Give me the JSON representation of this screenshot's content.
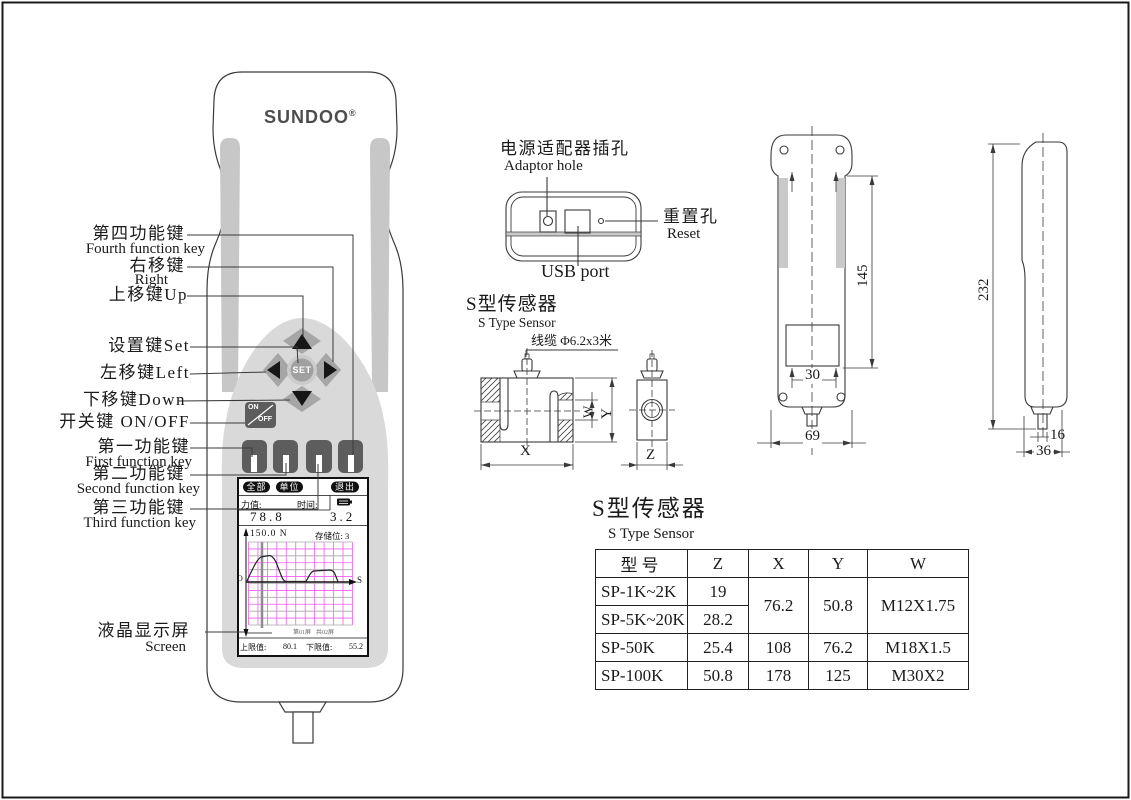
{
  "brand": {
    "logo_text": "SUNDOO",
    "logo_reg": "®"
  },
  "device_callouts": {
    "fourth_fn_cn": "第四功能键",
    "fourth_fn_en": "Fourth function key",
    "right_cn": "右移键",
    "right_en": "Right",
    "up": "上移键Up",
    "set": "设置键Set",
    "left": "左移键Left",
    "down": "下移键Down",
    "onoff": "开关键 ON/OFF",
    "first_fn_cn": "第一功能键",
    "first_fn_en": "First function key",
    "second_fn_cn": "第二功能键",
    "second_fn_en": "Second function key",
    "third_fn_cn": "第三功能键",
    "third_fn_en": "Third function key",
    "screen_cn": "液晶显示屏",
    "screen_en": "Screen"
  },
  "keypad": {
    "set": "SET",
    "on": "ON",
    "off": "OFF"
  },
  "screen": {
    "softkey_all": "全部",
    "softkey_unit": "单位",
    "softkey_exit": "退出",
    "force_label": "力值:",
    "time_label": "时间:",
    "force_value": "78.8",
    "time_value": "3.2",
    "fullscale_label": "150.0 N",
    "storage_label": "存储位: 3",
    "origin": "O",
    "axis_s": "S",
    "page_cur": "第01屏",
    "page_total": "共02屏",
    "upper_label": "上限值:",
    "upper_value": "80.1",
    "lower_label": "下限值:",
    "lower_value": "55.2"
  },
  "top_view": {
    "adaptor_cn": "电源适配器插孔",
    "adaptor_en": "Adaptor hole",
    "reset_cn": "重置孔",
    "reset_en": "Reset",
    "usb": "USB port"
  },
  "sensor": {
    "title_cn": "S型传感器",
    "title_en": "S Type Sensor",
    "cable": "线缆 Φ6.2x3米",
    "dim_x": "X",
    "dim_y": "Y",
    "dim_w": "W",
    "dim_z": "Z"
  },
  "rear_view": {
    "d145": "145",
    "d30": "30",
    "d69": "69"
  },
  "side_view": {
    "d232": "232",
    "d16": "16",
    "d36": "36"
  },
  "spec_table": {
    "title_cn": "S型传感器",
    "title_en": "S Type Sensor",
    "headers": [
      "型号",
      "Z",
      "X",
      "Y",
      "W"
    ],
    "rows": [
      {
        "model": "SP-1K~2K",
        "z": "19"
      },
      {
        "model": "SP-5K~20K",
        "z": "28.2"
      },
      {
        "model": "SP-50K",
        "z": "25.4",
        "x": "108",
        "y": "76.2",
        "w": "M18X1.5"
      },
      {
        "model": "SP-100K",
        "z": "50.8",
        "x": "178",
        "y": "125",
        "w": "M30X2"
      }
    ],
    "merged": {
      "x": "76.2",
      "y": "50.8",
      "w": "M12X1.75"
    }
  }
}
